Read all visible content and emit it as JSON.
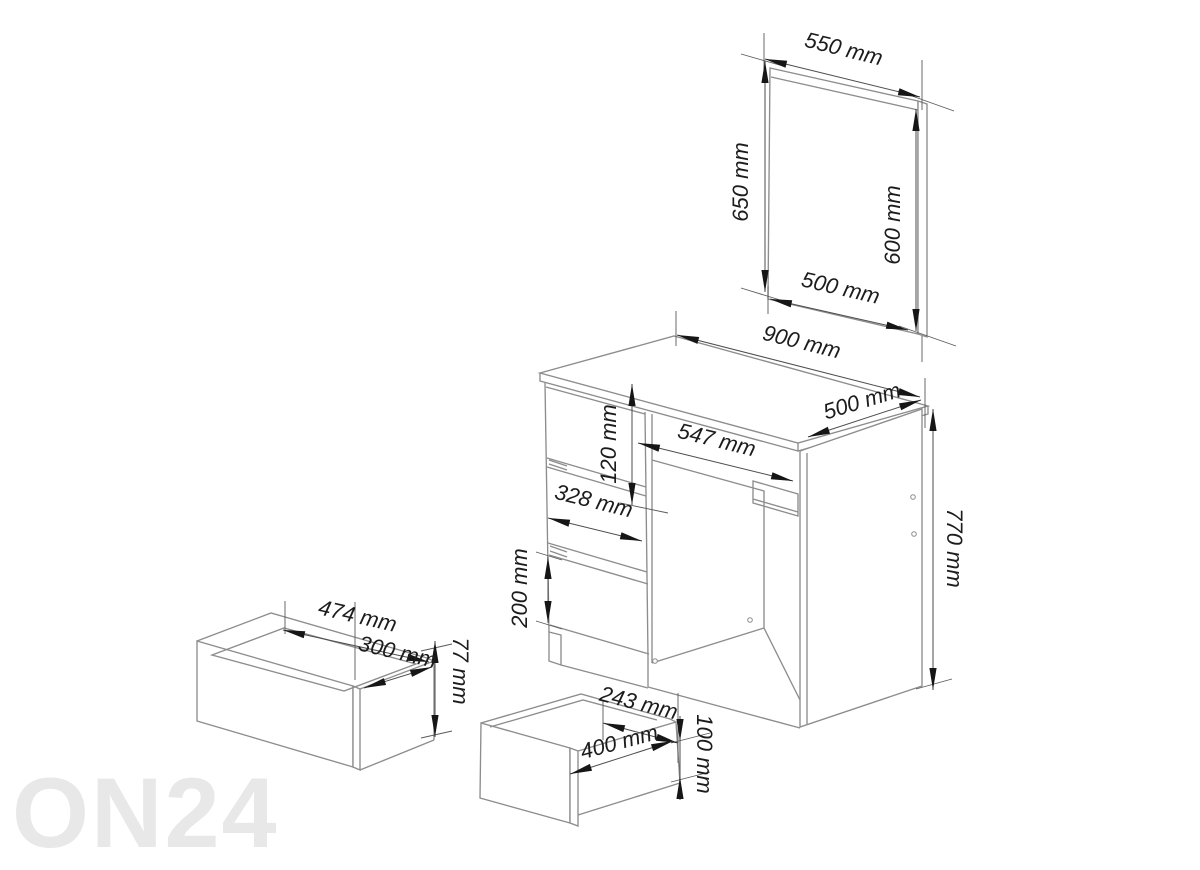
{
  "watermark": {
    "text": "ON24"
  },
  "dimensions": {
    "mirror_top_width": "550 mm",
    "mirror_left_height": "650 mm",
    "mirror_right_height": "600 mm",
    "mirror_bottom_width": "500 mm",
    "desk_top_width": "900 mm",
    "desk_top_depth": "500 mm",
    "desk_height": "770 mm",
    "top_drawer_height": "120 mm",
    "knee_opening_width": "547 mm",
    "drawer_front_width": "328 mm",
    "bottom_drawer_height": "200 mm",
    "side_drawer_width": "474 mm",
    "side_drawer_depth": "300 mm",
    "side_drawer_height": "77 mm",
    "center_drawer_back_width": "243 mm",
    "center_drawer_front_width": "400 mm",
    "center_drawer_height": "100 mm"
  }
}
